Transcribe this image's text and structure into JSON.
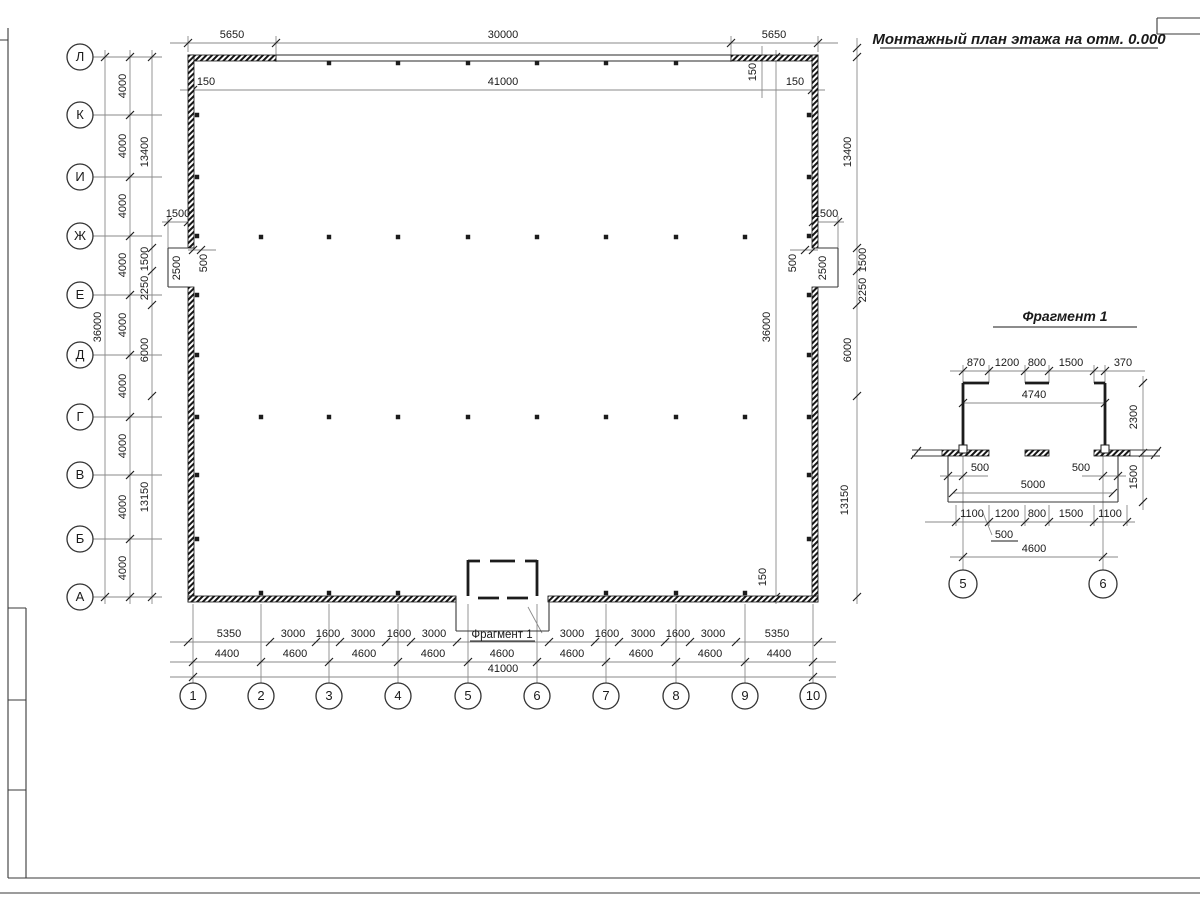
{
  "sheet": {
    "title": "Монтажный план этажа на отм. 0.000"
  },
  "plan": {
    "row_axis_labels": [
      "Л",
      "К",
      "И",
      "Ж",
      "Е",
      "Д",
      "Г",
      "В",
      "Б",
      "А"
    ],
    "col_axis_labels": [
      "1",
      "2",
      "3",
      "4",
      "5",
      "6",
      "7",
      "8",
      "9",
      "10"
    ],
    "top_dims_outer": [
      "5650",
      "30000",
      "5650"
    ],
    "top_dims_inner": [
      "150",
      "41000",
      "150"
    ],
    "top_right_offset": "150",
    "bottom_right_offset": "150",
    "left_overall": "36000",
    "right_overall": "36000",
    "left_bays": [
      "4000",
      "4000",
      "4000",
      "4000",
      "4000",
      "4000",
      "4000",
      "4000",
      "4000"
    ],
    "left_chain": [
      "13400",
      "1500",
      "2250",
      "6000",
      "13150"
    ],
    "right_chain": [
      "13400",
      "1500",
      "2250",
      "6000",
      "13150"
    ],
    "niche_left": {
      "width": "1500",
      "height": "2500",
      "depth": "500"
    },
    "niche_right": {
      "width": "1500",
      "height": "2500",
      "depth": "500"
    },
    "bottom_row1": [
      "5350",
      "3000",
      "1600",
      "3000",
      "1600",
      "3000",
      "3000",
      "1600",
      "3000",
      "1600",
      "3000",
      "5350"
    ],
    "bottom_row2": [
      "4400",
      "4600",
      "4600",
      "4600",
      "4600",
      "4600",
      "4600",
      "4600",
      "4400"
    ],
    "bottom_total": "41000",
    "callout": "Фрагмент 1"
  },
  "fragment": {
    "title": "Фрагмент 1",
    "top_dims": [
      "870",
      "1200",
      "800",
      "1500",
      "370"
    ],
    "inner_width": "4740",
    "depth": "2300",
    "offset_left": "500",
    "offset_right": "500",
    "porch_width": "5000",
    "porch_depth": "1500",
    "bottom_dims": [
      "1100",
      "1200",
      "800",
      "1500",
      "1100"
    ],
    "pier_note": "500",
    "axis_span": "4600",
    "axis_labels": [
      "5",
      "6"
    ]
  }
}
